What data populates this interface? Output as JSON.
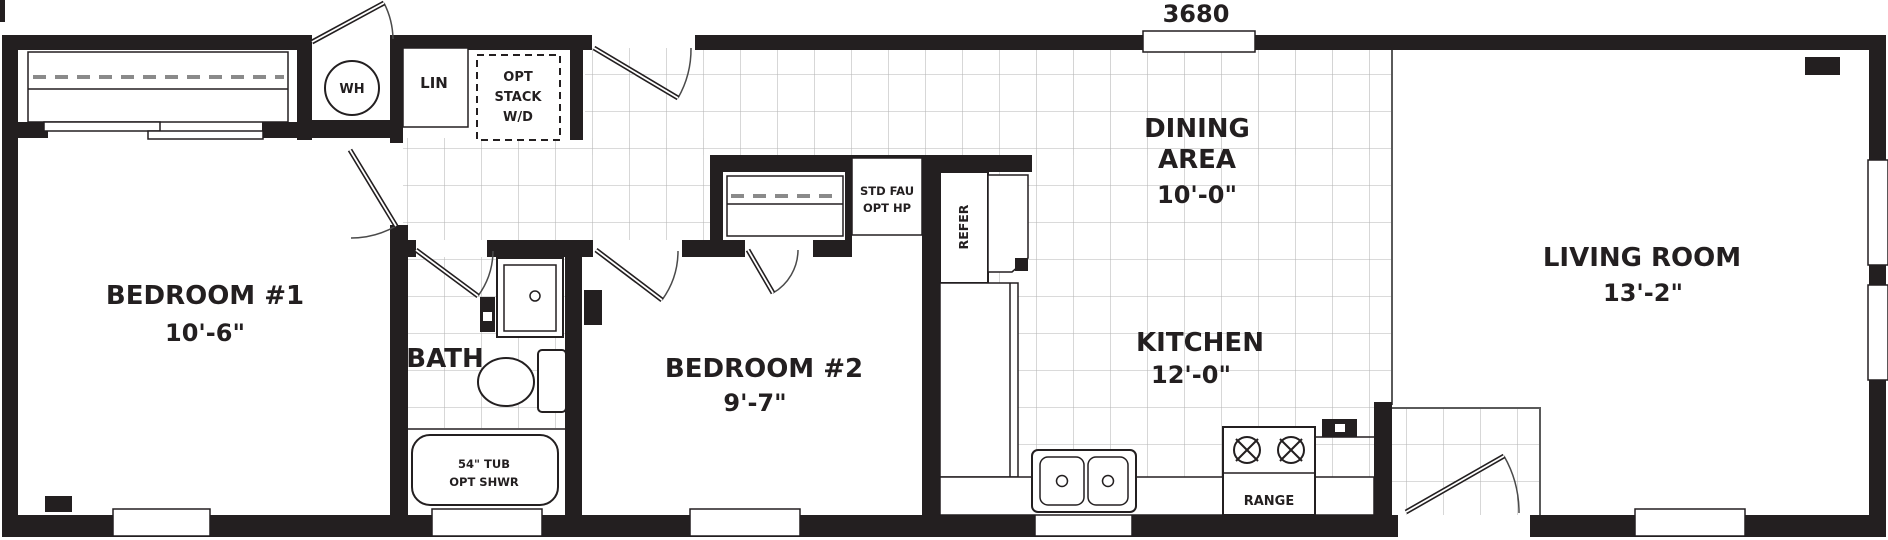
{
  "plan": {
    "model_number": "3680"
  },
  "rooms": {
    "bedroom1": {
      "name": "BEDROOM #1",
      "dim": "10'-6\""
    },
    "bath": {
      "name": "BATH"
    },
    "bedroom2": {
      "name": "BEDROOM #2",
      "dim": "9'-7\""
    },
    "dining": {
      "line1": "DINING",
      "line2": "AREA",
      "dim": "10'-0\""
    },
    "kitchen": {
      "name": "KITCHEN",
      "dim": "12'-0\""
    },
    "living": {
      "name": "LIVING ROOM",
      "dim": "13'-2\""
    }
  },
  "fixtures": {
    "water_heater": "WH",
    "linen": "LIN",
    "washer_dryer_line1": "OPT",
    "washer_dryer_line2": "STACK",
    "washer_dryer_line3": "W/D",
    "furnace_line1": "STD FAU",
    "furnace_line2": "OPT HP",
    "refrigerator": "REFER",
    "range": "RANGE",
    "tub_line1": "54\" TUB",
    "tub_line2": "OPT SHWR"
  },
  "colors": {
    "wall": "#231f20",
    "tile_line": "#b6b6b6",
    "background": "#ffffff"
  }
}
